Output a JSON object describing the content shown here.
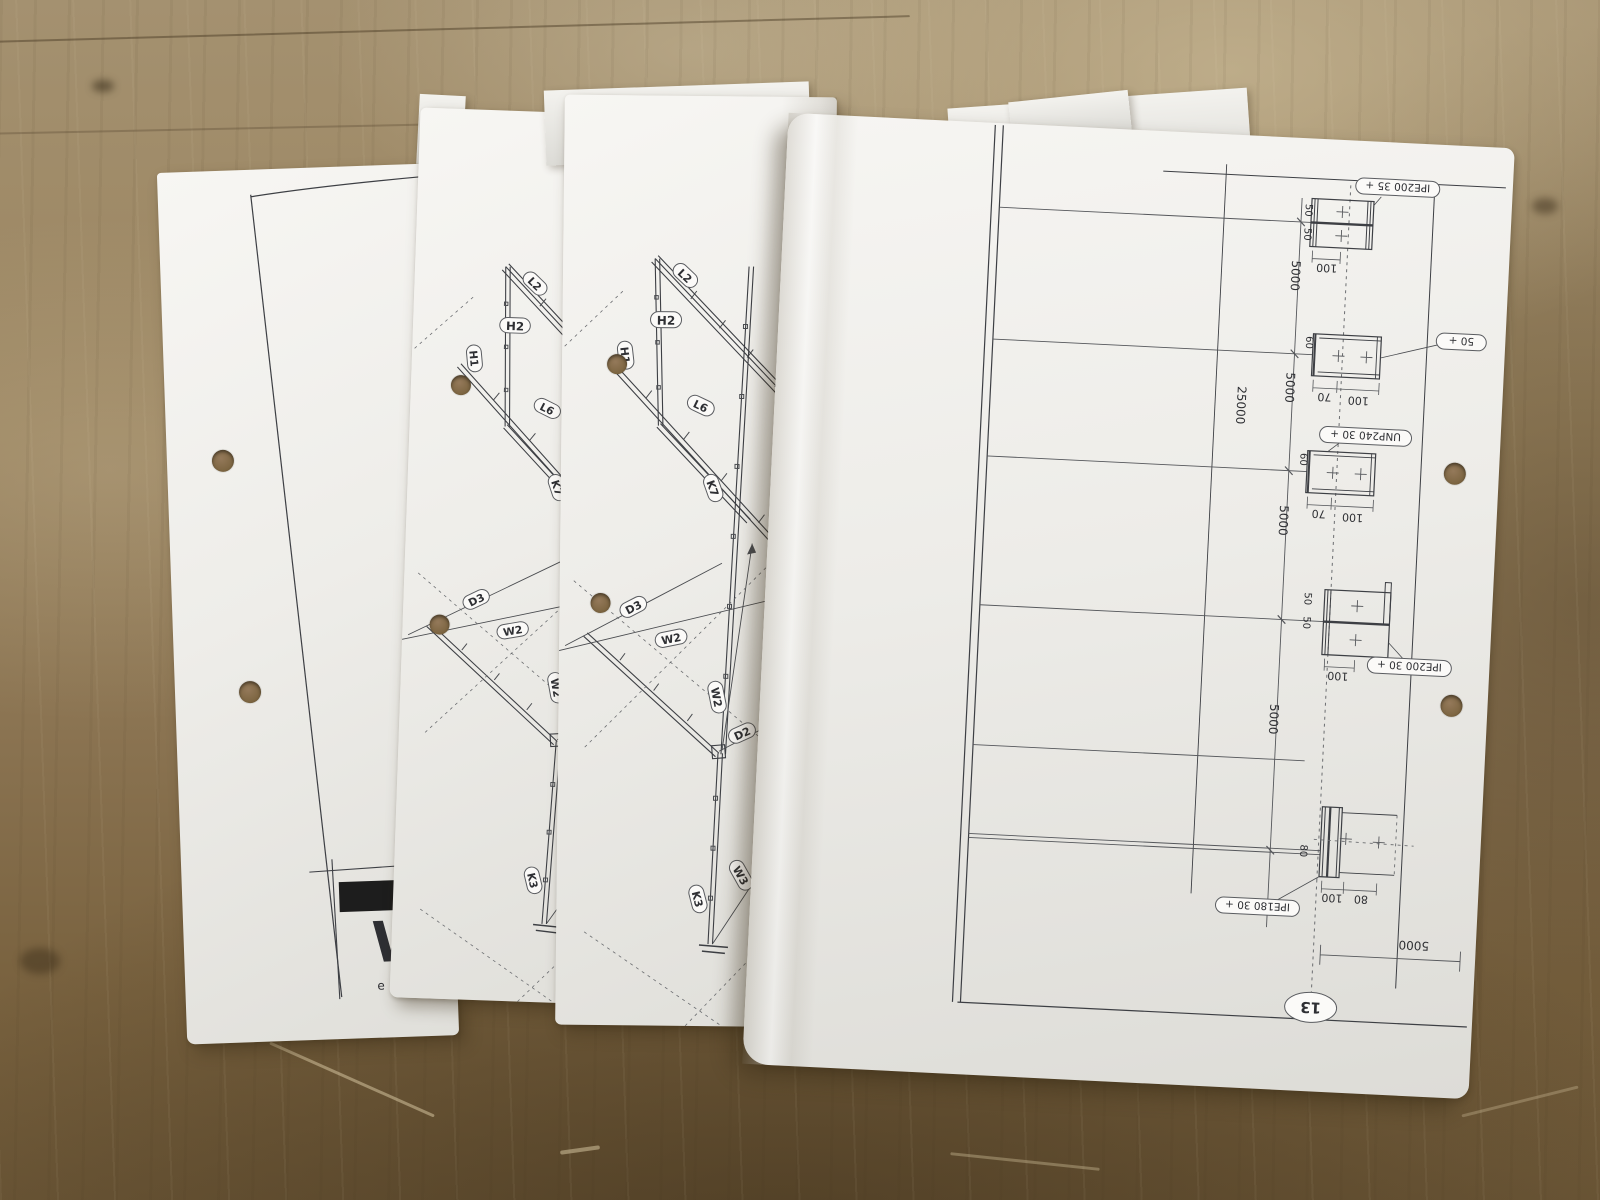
{
  "colors": {
    "wood_light": "#a8926c",
    "wood_mid": "#8f7a58",
    "wood_dark": "#6b5636",
    "paper": "#f2f1ed",
    "ink": "#3d3f44"
  },
  "cover_sheet": {
    "logo_letter": "W",
    "logo_subtext": "e n"
  },
  "frame_sheet": {
    "labels": {
      "l2": "L2",
      "h2": "H2",
      "h1": "H1",
      "l6": "L6",
      "k7": "K7",
      "d3": "D3",
      "w2": "W2",
      "d2": "D2",
      "w3": "W3",
      "k3": "K3"
    },
    "sheet_number": "11"
  },
  "detail_sheet": {
    "tags": {
      "beam_top": "IPE200 35 +",
      "beam_mid_partial": "50 +",
      "channel": "UNP240 30 +",
      "beam_lower": "IPE200 30 +",
      "column_base": "IPE180 30 +"
    },
    "dims": {
      "bay": "5000",
      "total": "25000",
      "hundred": "100",
      "seventy": "70",
      "sixty": "60",
      "eighty": "80",
      "fifty": "50"
    },
    "grid_label": "13"
  }
}
